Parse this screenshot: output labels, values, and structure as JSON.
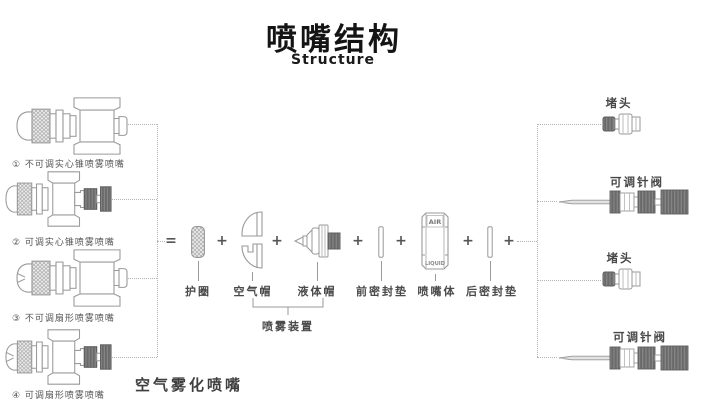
{
  "header": {
    "title": "喷嘴结构",
    "subtitle": "Structure"
  },
  "operators": {
    "equals": "=",
    "plus": "+"
  },
  "left_nozzles": [
    {
      "label": "① 不可调实心锥喷雾喷嘴"
    },
    {
      "label": "② 可调实心锥喷雾喷嘴"
    },
    {
      "label": "③ 不可调扇形喷雾喷嘴"
    },
    {
      "label": "④ 可调扇形喷雾喷嘴"
    }
  ],
  "components": [
    {
      "label": "护圈"
    },
    {
      "label": "空气帽"
    },
    {
      "label": "液体帽"
    },
    {
      "label": "前密封垫"
    },
    {
      "label": "喷嘴体"
    },
    {
      "label": "后密封垫"
    }
  ],
  "nozzle_body_markings": {
    "top": "AIR",
    "bottom": "LIQUID"
  },
  "group_label": "喷雾装置",
  "category_label": "空气雾化喷嘴",
  "right_parts": [
    {
      "label": "堵头"
    },
    {
      "label": "可调针阀"
    },
    {
      "label": "堵头"
    },
    {
      "label": "可调针阀"
    }
  ],
  "colors": {
    "line": "#9a9a9a",
    "dark_part": "#6a6a6a",
    "dotted": "#b3b3b3",
    "label_text": "#4a4a4a",
    "title_text": "#141414"
  }
}
